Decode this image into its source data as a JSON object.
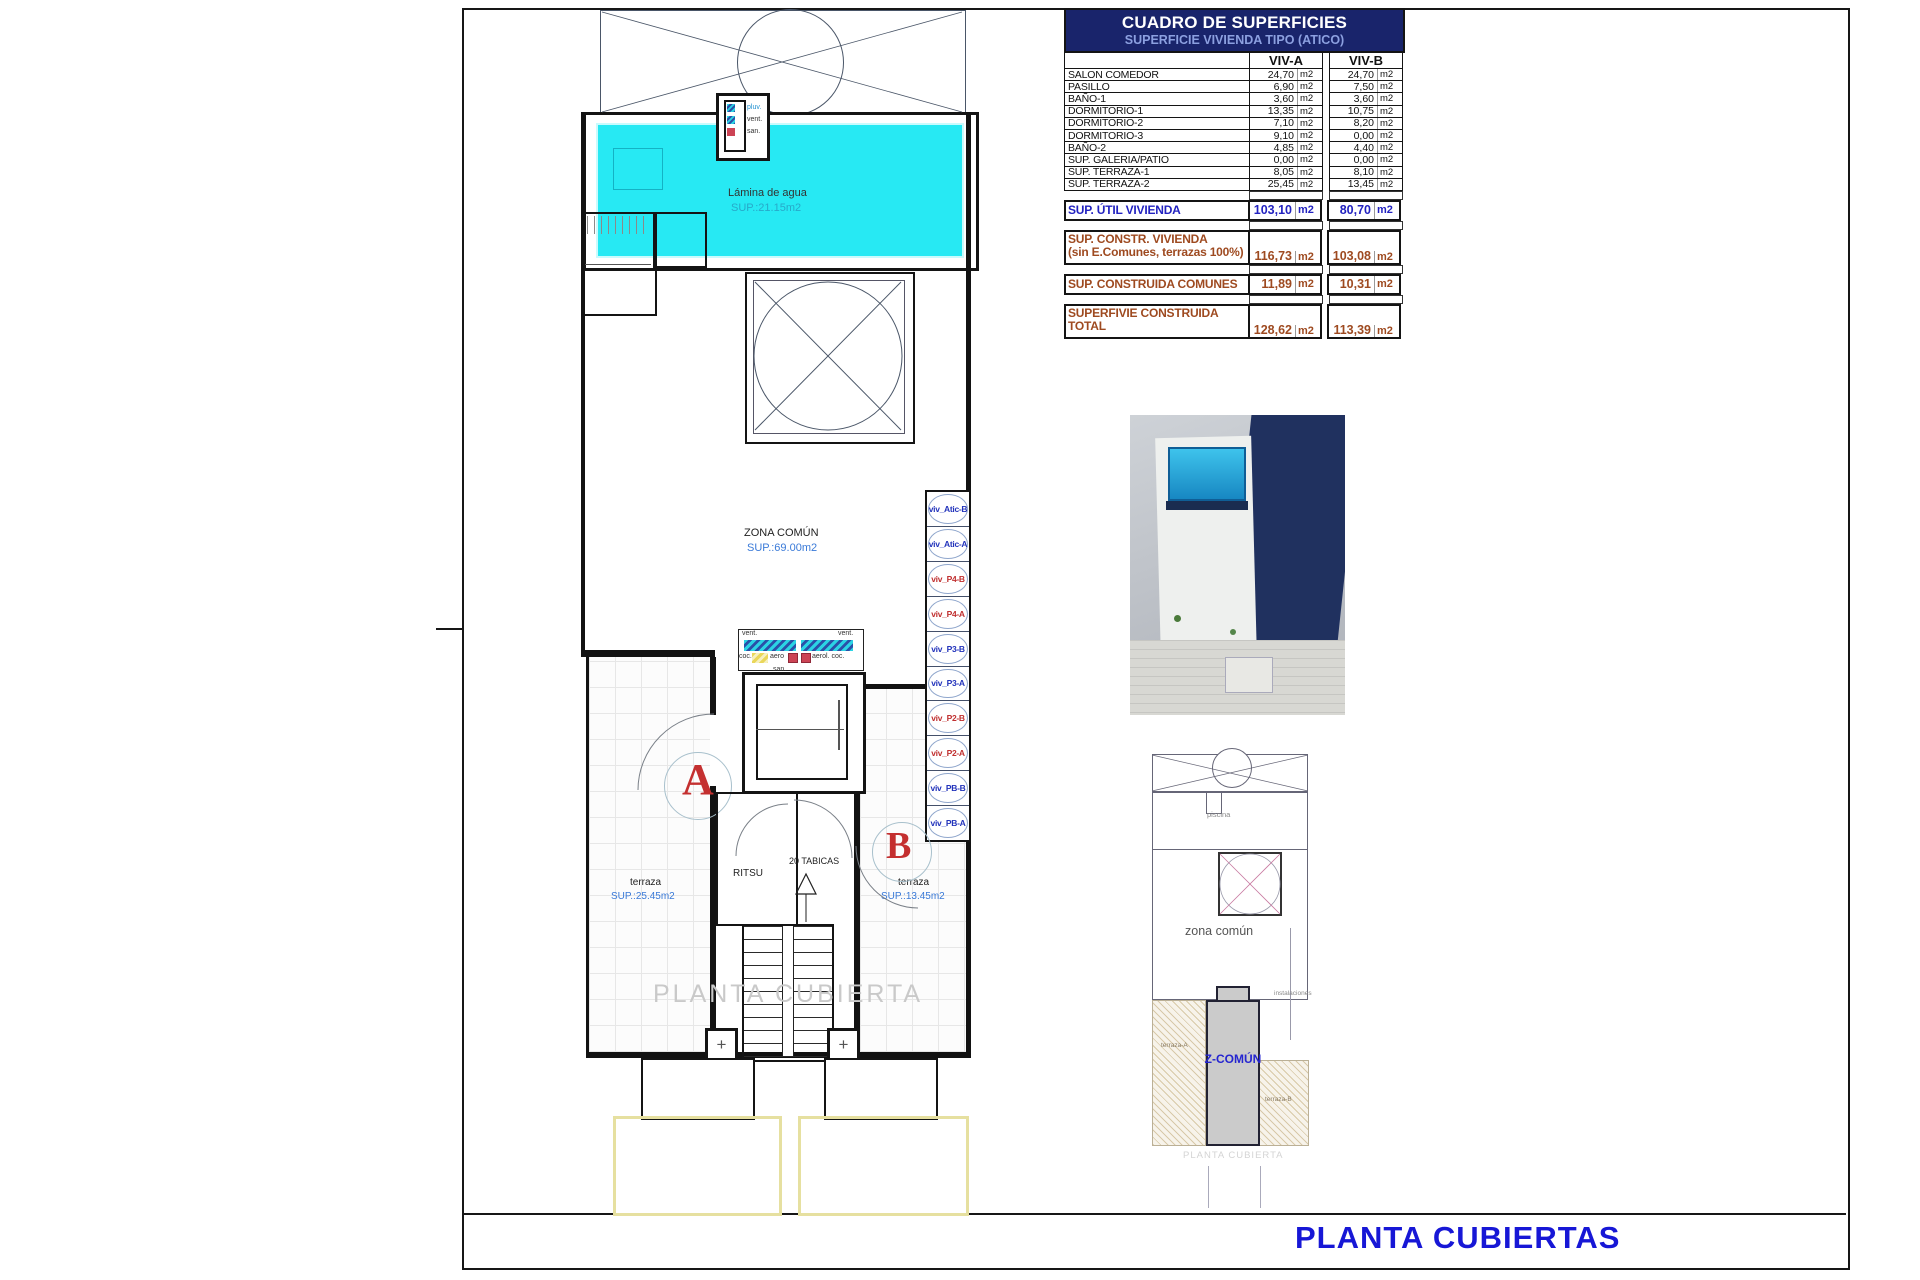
{
  "sheet": {
    "title": "PLANTA CUBIERTAS"
  },
  "table": {
    "title": "CUADRO DE SUPERFICIES",
    "subtitle": "SUPERFICIE VIVIENDA TIPO (ATICO)",
    "col_a": "VIV-A",
    "col_b": "VIV-B",
    "unit": "m2",
    "rows": [
      {
        "label": "SALON COMEDOR",
        "a": "24,70",
        "b": "24,70"
      },
      {
        "label": "PASILLO",
        "a": "6,90",
        "b": "7,50"
      },
      {
        "label": "BAÑO-1",
        "a": "3,60",
        "b": "3,60"
      },
      {
        "label": "DORMITORIO-1",
        "a": "13,35",
        "b": "10,75"
      },
      {
        "label": "DORMITORIO-2",
        "a": "7,10",
        "b": "8,20"
      },
      {
        "label": "DORMITORIO-3",
        "a": "9,10",
        "b": "0,00"
      },
      {
        "label": "BAÑO-2",
        "a": "4,85",
        "b": "4,40"
      },
      {
        "label": "SUP. GALERIA/PATIO",
        "a": "0,00",
        "b": "0,00"
      },
      {
        "label": "SUP. TERRAZA-1",
        "a": "8,05",
        "b": "8,10"
      },
      {
        "label": "SUP. TERRAZA-2",
        "a": "25,45",
        "b": "13,45"
      }
    ],
    "summary": {
      "util": {
        "label": "SUP. ÚTIL VIVIENDA",
        "a": "103,10",
        "b": "80,70"
      },
      "constr": {
        "label": "SUP. CONSTR. VIVIENDA",
        "label2": "(sin E.Comunes, terrazas 100%)",
        "a": "116,73",
        "b": "103,08"
      },
      "comunes": {
        "label": "SUP. CONSTRUIDA COMUNES",
        "a": "11,89",
        "b": "10,31"
      },
      "total": {
        "label": "SUPERFIVIE CONSTRUIDA",
        "label2": "TOTAL",
        "a": "128,62",
        "b": "113,39"
      }
    }
  },
  "plan": {
    "pool": {
      "name": "Lámina de agua",
      "area": "SUP.:21.15m2"
    },
    "zona_comun": {
      "name": "ZONA COMÚN",
      "area": "SUP.:69.00m2"
    },
    "terraza_a": {
      "name": "terraza",
      "area": "SUP.:25.45m2"
    },
    "terraza_b": {
      "name": "terraza",
      "area": "SUP.:13.45m2"
    },
    "ritsu": "RITSU",
    "tabicas": "20 TABICAS",
    "unit_a": "A",
    "unit_b": "B",
    "marker": "+",
    "watermark": "PLANTA CUBIERTA",
    "shaft": {
      "pluv": "pluv.",
      "vent": "vent.",
      "san": "san."
    },
    "ducts": {
      "vent_l": "vent.",
      "vent_r": "vent.",
      "coc": "coc.",
      "aero": "aero",
      "aerol": "aerol. coc.",
      "san": "san."
    }
  },
  "viv_stack": [
    {
      "label": "viv_Atic-B",
      "color": "blue"
    },
    {
      "label": "viv_Atic-A",
      "color": "blue"
    },
    {
      "label": "viv_P4-B",
      "color": "red"
    },
    {
      "label": "viv_P4-A",
      "color": "red"
    },
    {
      "label": "viv_P3-B",
      "color": "blue"
    },
    {
      "label": "viv_P3-A",
      "color": "blue"
    },
    {
      "label": "viv_P2-B",
      "color": "red"
    },
    {
      "label": "viv_P2-A",
      "color": "red"
    },
    {
      "label": "viv_PB-B",
      "color": "blue"
    },
    {
      "label": "viv_PB-A",
      "color": "blue"
    }
  ],
  "site_plan": {
    "piscina": "piscina",
    "zona": "zona común",
    "instalaciones": "instalaciones",
    "terraza_a": "terraza-A",
    "terraza_b": "terraza-B",
    "z_comun": "Z-COMÚN",
    "caption": "PLANTA CUBIERTA"
  },
  "colors": {
    "pool": "#27e9f3",
    "table_header_bg": "#19246b",
    "summary_blue": "#2222c0",
    "summary_brown": "#9e4a20",
    "title_blue": "#1717d6",
    "viv_blue": "#2233bb",
    "viv_red": "#c03030"
  }
}
